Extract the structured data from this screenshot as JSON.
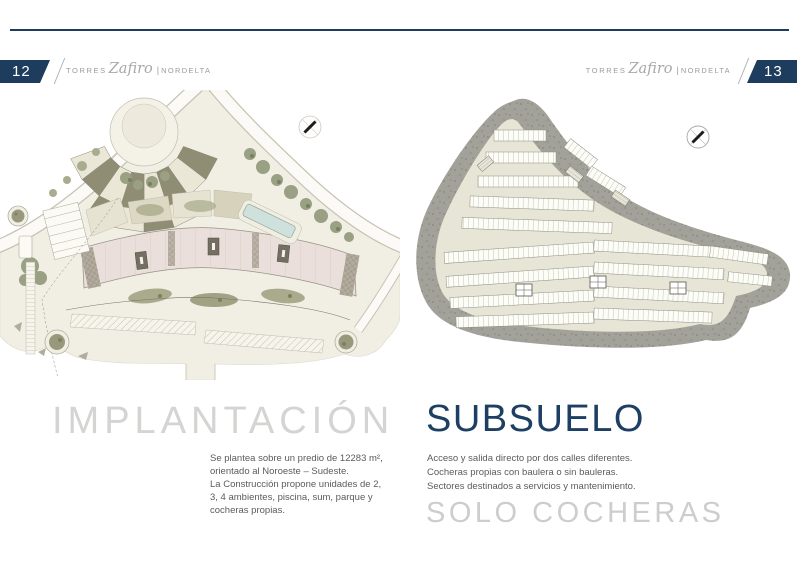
{
  "header": {
    "left_page_number": "12",
    "right_page_number": "13",
    "brand": {
      "torres": "Torres",
      "zafiro": "Zafiro",
      "divider": "|",
      "nordelta": "NORDELTA"
    }
  },
  "left_section": {
    "title": "IMPLANTACIÓN",
    "description": "Se plantea sobre un predio de 12283 m²,\norientado al Noroeste – Sudeste.\nLa Construcción propone unidades de 2,\n3, 4 ambientes,  piscina, sum, parque y\ncocheras propias."
  },
  "right_section": {
    "title": "SUBSUELO",
    "description": "Acceso y salida directo por dos calles diferentes.\nCocheras propias con baulera o sin bauleras.\nSectores destinados a servicios y mantenimiento.",
    "subtitle": "SOLO COCHERAS"
  },
  "colors": {
    "accent_navy": "#1d3c5e",
    "title_gray": "#d4d4d2",
    "body_text": "#5b5b59",
    "site_ground": "#f1eee4",
    "building_pink": "#ebdfdb",
    "landscape_olive": "#98997c",
    "pool_blue": "#cfe1dd",
    "subsoil_gray": "#a2a29a"
  }
}
